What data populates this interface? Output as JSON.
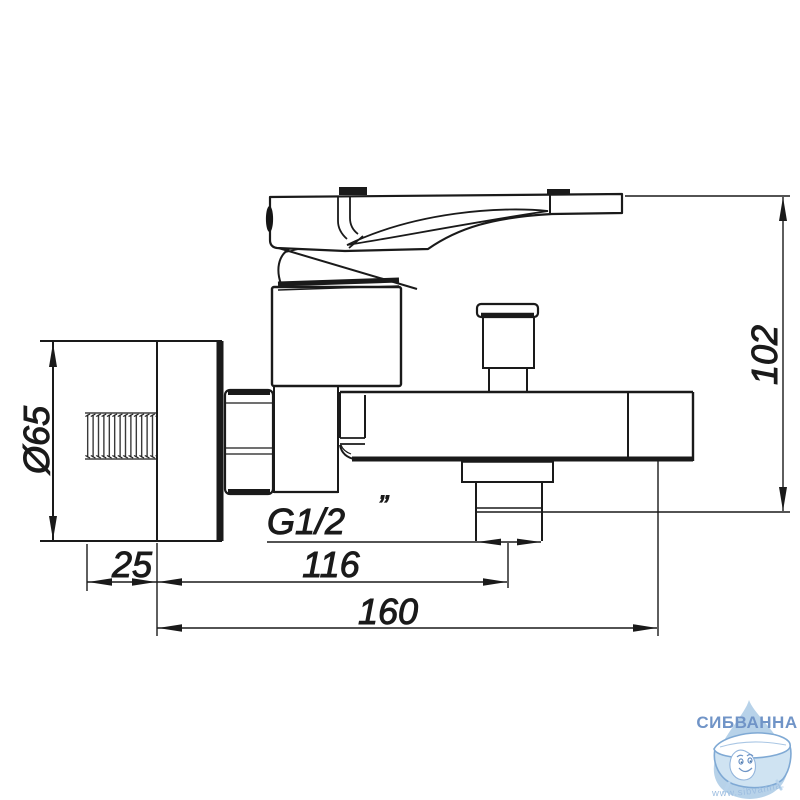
{
  "drawing": {
    "title": "wall-mounted bath mixer faucet dimension drawing",
    "dimensions": {
      "flange_diameter": "Ø65",
      "flange_depth": "25",
      "wall_to_outlet_center": "116",
      "total_length": "160",
      "body_height": "102",
      "thread_size": "G1/2",
      "thread_inch_mark": "”"
    },
    "colors": {
      "line": "#1a1a1a",
      "background": "#ffffff"
    }
  },
  "watermark": {
    "brand": "СИБВАННА",
    "url": "www.sibvanna.ru",
    "colors": {
      "brand_blue": "#7094c7",
      "drop_fill": "#b7d2e9",
      "tub_outline": "#7fa9d4",
      "tub_fill": "#cfe3f2",
      "url_blue": "#9cbde0"
    }
  }
}
